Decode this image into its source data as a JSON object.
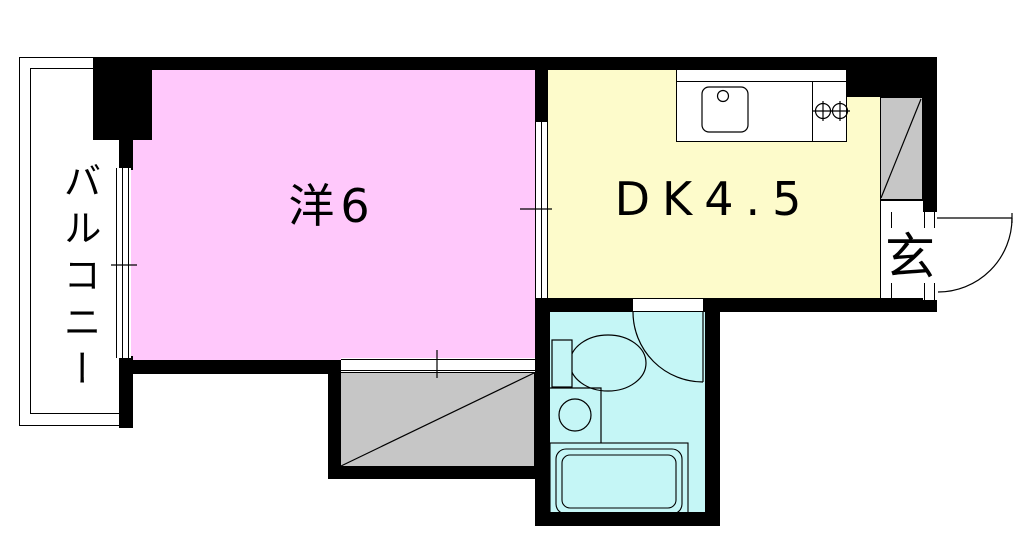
{
  "floorplan": {
    "rooms": {
      "balcony": {
        "label": "バルコニー"
      },
      "western_room": {
        "label": "洋6"
      },
      "dining_kitchen": {
        "label": "DK4.5"
      },
      "entrance": {
        "label": "玄"
      }
    },
    "colors": {
      "western_room_fill": "#ffc8fb",
      "dining_kitchen_fill": "#fdfbcb",
      "bathroom_fill": "#c5f6f6",
      "closet_fill": "#c6c6c6",
      "wall": "#000000",
      "background": "#ffffff"
    },
    "fixtures": [
      "kitchen-sink",
      "kitchen-faucet",
      "gas-stove-burners",
      "toilet",
      "washbasin",
      "bathtub",
      "bathroom-swing-door",
      "entrance-swing-door",
      "sliding-door-western-dk",
      "closet-sliding-door",
      "balcony-window",
      "closet-diagonal",
      "shoe-closet-diagonal"
    ]
  }
}
